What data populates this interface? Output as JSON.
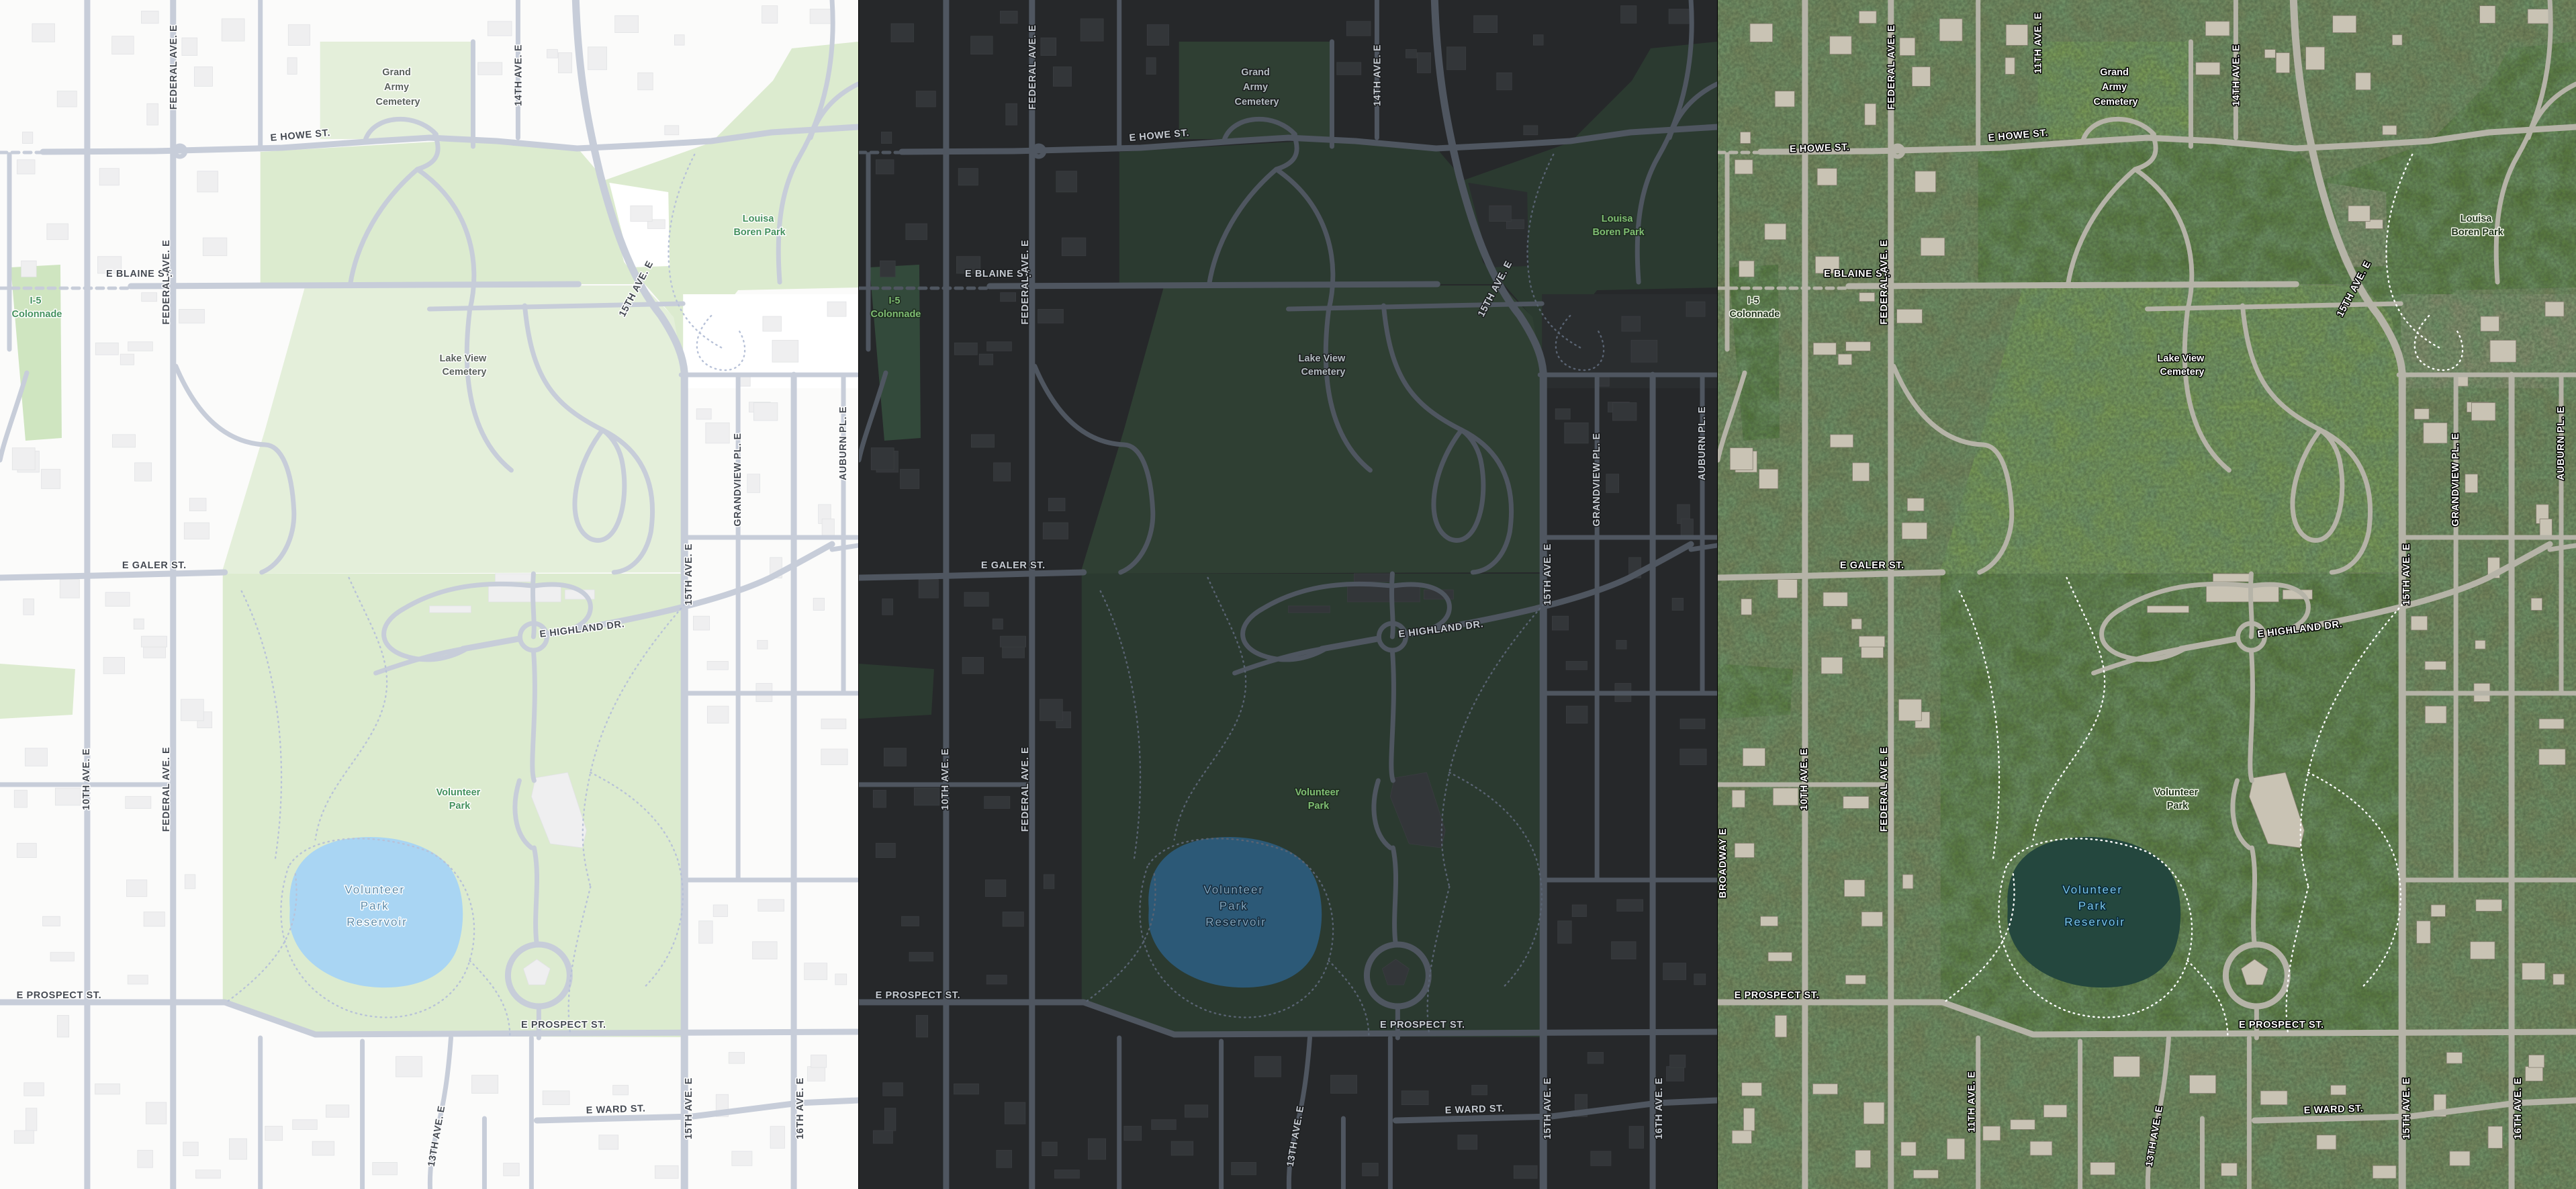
{
  "labels": {
    "grand_army": {
      "l1": "Grand",
      "l2": "Army",
      "l3": "Cemetery"
    },
    "louisa": {
      "l1": "Louisa",
      "l2": "Boren Park"
    },
    "i5": {
      "l1": "I-5",
      "l2": "Colonnade"
    },
    "lake_view": {
      "l1": "Lake View",
      "l2": "Cemetery"
    },
    "volunteer_park": {
      "l1": "Volunteer",
      "l2": "Park"
    },
    "reservoir": {
      "l1": "Volunteer",
      "l2": "Park",
      "l3": "Reservoir"
    },
    "e_howe": "E HOWE ST.",
    "e_blaine": "E BLAINE ST.",
    "e_galer": "E GALER ST.",
    "e_highland": "E HIGHLAND DR.",
    "e_prospect": "E PROSPECT ST.",
    "e_ward": "E WARD ST.",
    "tenth": "10TH AVE. E",
    "eleventh": "11TH AVE. E",
    "thirteenth": "13TH AVE. E",
    "fourteenth": "14TH AVE. E",
    "fifteenth": "15TH AVE. E",
    "sixteenth": "16TH AVE. E",
    "federal": "FEDERAL AVE. E",
    "grandview": "GRANDVIEW PL. E",
    "auburn": "AUBURN PL. E",
    "broadway": "BROADWAY E"
  },
  "themes": {
    "light": {
      "base": "#fbfbfa",
      "block": "#ffffff",
      "building": "#efeff0",
      "building_line": "#e2e3e5",
      "road": "#c7cdd9",
      "park": "#dcebcf",
      "cemetery": "#e4efda",
      "colonnade": "#cfe5c0",
      "water": "#a9d5f3",
      "trail": "#b8c2d8",
      "street_label": "#454a52",
      "street_halo": "#ffffff",
      "park_label": "#44915e",
      "park_halo": "#ffffff",
      "poi_label": "#59615b",
      "poi_halo": "#ffffff",
      "water_label": "#5d8cab",
      "water_halo": "#ffffff",
      "sat_layer": "0"
    },
    "dark": {
      "base": "#26282a",
      "block": "#2a2d2f",
      "building": "#333639",
      "building_line": "#3a3d40",
      "road": "#4f5660",
      "park": "#2b3a30",
      "cemetery": "#2f3f33",
      "colonnade": "#334a3b",
      "water": "#2c5977",
      "trail": "#596372",
      "street_label": "#c6cbd2",
      "street_halo": "#191b1d",
      "park_label": "#7fbd72",
      "park_halo": "#1c2a1e",
      "poi_label": "#b3bbc0",
      "poi_halo": "#191b1d",
      "water_label": "#7fa3bb",
      "water_halo": "#15293a",
      "sat_layer": "0"
    },
    "satellite": {
      "base": "#75845c",
      "block": "#868e6f",
      "building": "#c9c3b4",
      "building_line": "#857f70",
      "road": "#b5b3a7",
      "park": "#59793f",
      "cemetery": "#7a9a57",
      "colonnade": "#53743c",
      "water": "#24473e",
      "trail": "#ffffff",
      "street_label": "#ffffff",
      "street_halo": "#000000",
      "park_label": "#20351b",
      "park_halo": "#f2f5ea",
      "poi_label": "#ffffff",
      "poi_halo": "#000000",
      "water_label": "#7cc5e8",
      "water_halo": "#062738",
      "sat_layer": "1"
    }
  }
}
